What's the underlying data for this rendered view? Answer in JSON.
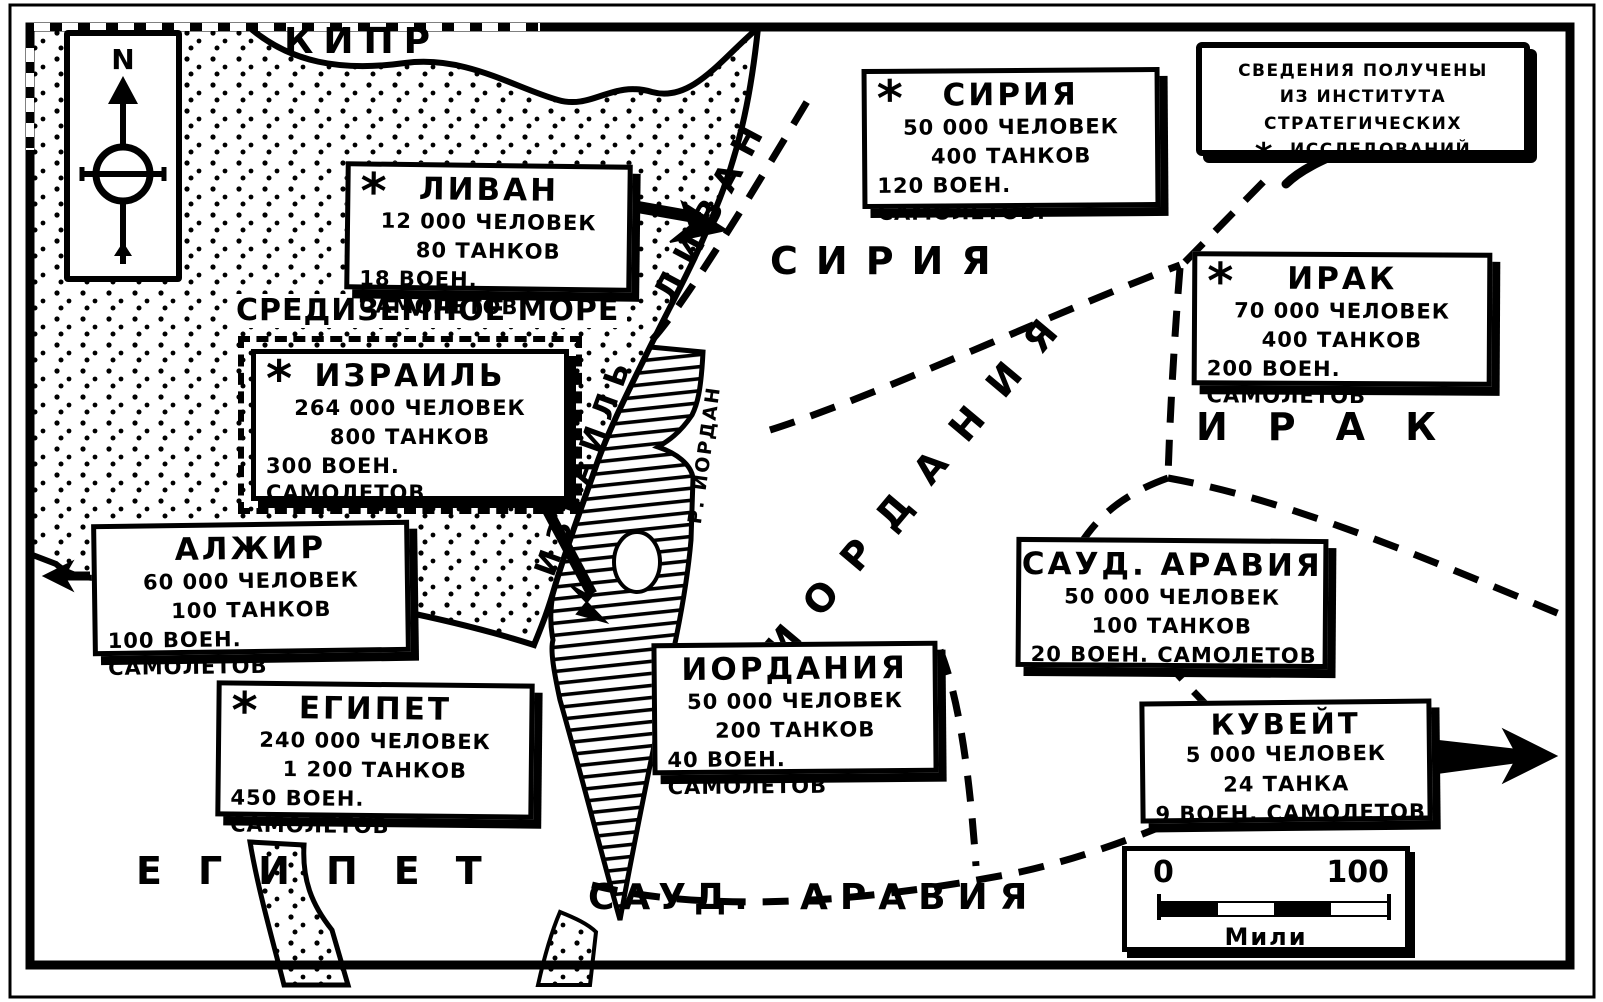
{
  "compass": {
    "label": "N"
  },
  "symbols": {
    "asterisk": "*"
  },
  "legend": {
    "line1": "СВЕДЕНИЯ ПОЛУЧЕНЫ",
    "line2": "ИЗ ИНСТИТУТА СТРАТЕГИЧЕСКИХ",
    "line3": "ИССЛЕДОВАНИЙ"
  },
  "map_labels": {
    "cyprus": "КИПР",
    "mediterranean": "СРЕДИЗЕМНОЕ МОРЕ",
    "syria_region": "СИРИЯ",
    "iraq_region": "ИРАК",
    "jordan_region": "ИОРДАНИЯ",
    "egypt_region": "ЕГИПЕТ",
    "saudi_region_1": "САУД.",
    "saudi_region_2": "АРАВИЯ",
    "lebanon_coast": "ЛИВАН",
    "israel_coast": "ИЗРАИЛЬ",
    "jordan_river": "Р. ИОРДАН"
  },
  "forces": [
    {
      "id": "lebanon",
      "has_asterisk": true,
      "name": "ЛИВАН",
      "men": "12 000 ЧЕЛОВЕК",
      "tanks": "80 ТАНКОВ",
      "planes": "18 ВОЕН. САМОЛЕТОВ"
    },
    {
      "id": "syria",
      "has_asterisk": true,
      "name": "СИРИЯ",
      "men": "50 000 ЧЕЛОВЕК",
      "tanks": "400 ТАНКОВ",
      "planes": "120 ВОЕН. САМОЛЕТОВ."
    },
    {
      "id": "iraq",
      "has_asterisk": true,
      "name": "ИРАК",
      "men": "70 000 ЧЕЛОВЕК",
      "tanks": "400 ТАНКОВ",
      "planes": "200 ВОЕН. САМОЛЕТОВ"
    },
    {
      "id": "israel",
      "has_asterisk": true,
      "name": "ИЗРАИЛЬ",
      "men": "264 000 ЧЕЛОВЕК",
      "tanks": "800 ТАНКОВ",
      "planes": "300 ВОЕН. САМОЛЕТОВ"
    },
    {
      "id": "algeria",
      "has_asterisk": false,
      "name": "АЛЖИР",
      "men": "60 000 ЧЕЛОВЕК",
      "tanks": "100 ТАНКОВ",
      "planes": "100 ВОЕН. САМОЛЕТОВ"
    },
    {
      "id": "egypt",
      "has_asterisk": true,
      "name": "ЕГИПЕТ",
      "men": "240 000 ЧЕЛОВЕК",
      "tanks": "1 200 ТАНКОВ",
      "planes": "450 ВОЕН. САМОЛЕТОВ"
    },
    {
      "id": "jordan",
      "has_asterisk": false,
      "name": "ИОРДАНИЯ",
      "men": "50 000 ЧЕЛОВЕК",
      "tanks": "200 ТАНКОВ",
      "planes": "40 ВОЕН. САМОЛЕТОВ"
    },
    {
      "id": "saudi",
      "has_asterisk": false,
      "name": "САУД. АРАВИЯ",
      "men": "50 000 ЧЕЛОВЕК",
      "tanks": "100 ТАНКОВ",
      "planes": "20 ВОЕН. САМОЛЕТОВ"
    },
    {
      "id": "kuwait",
      "has_asterisk": false,
      "name": "КУВЕЙТ",
      "men": "5 000 ЧЕЛОВЕК",
      "tanks": "24 ТАНКА",
      "planes": "9 ВОЕН. САМОЛЕТОВ"
    }
  ],
  "scale": {
    "zero": "0",
    "hundred": "100",
    "unit": "Мили"
  }
}
